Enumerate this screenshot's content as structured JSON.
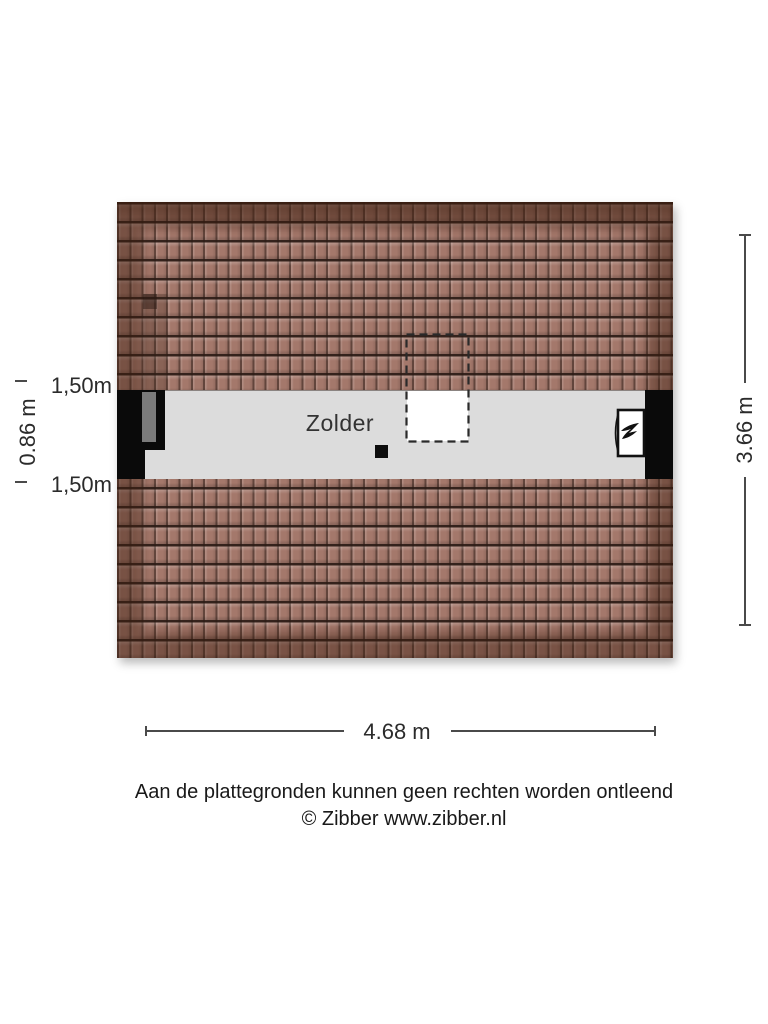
{
  "floorplan": {
    "room_label": "Zolder",
    "dimensions": {
      "width": "4.68 m",
      "depth": "3.66 m",
      "left_height": "0.86 m",
      "knee_wall_top": "1,50m",
      "knee_wall_bottom": "1,50m"
    },
    "colors": {
      "roof_tile": "#a4786b",
      "roof_tile_line": "#2b1b15",
      "roof_edge_shade": "#3e1f11",
      "floor": "#dcdcdc",
      "wall": "#0a0a0a",
      "duct_gray": "#7b7b7b",
      "dimension": "#4a4a4a"
    },
    "icons": {
      "boiler": "boiler-flame-icon"
    }
  },
  "footer": {
    "disclaimer": "Aan de plattegronden kunnen geen rechten worden ontleend",
    "copyright": "© Zibber www.zibber.nl"
  }
}
